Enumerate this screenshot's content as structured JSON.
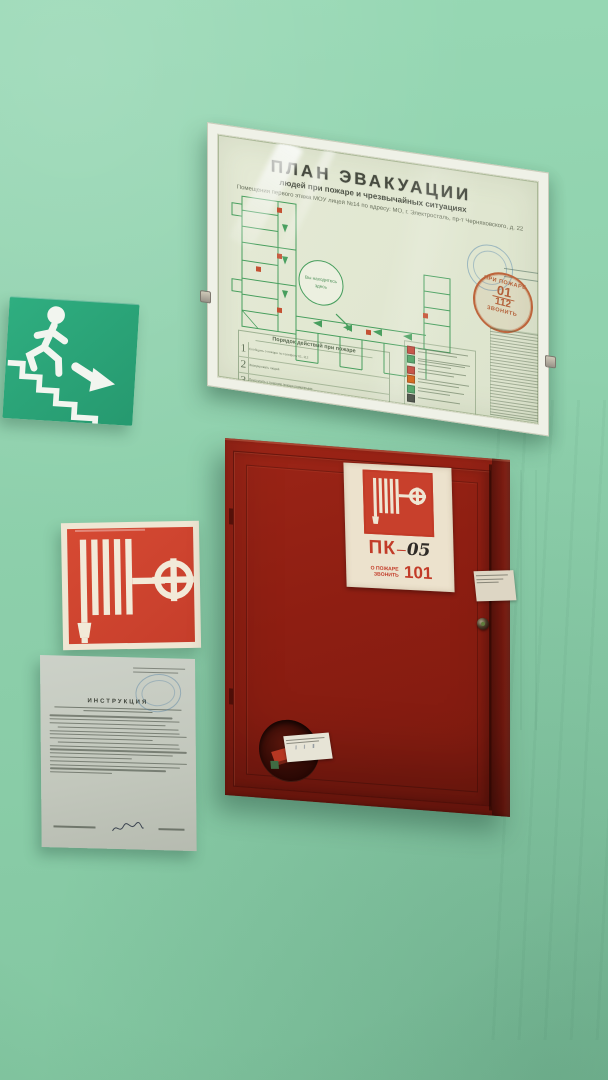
{
  "colors": {
    "wall": "#8fd1ad",
    "cabinet_red": "#8e1e12",
    "sign_red": "#cf4430",
    "sign_green": "#2aa77b",
    "plan_line_green": "#3f9b57",
    "badge_orange": "#b65930",
    "stamp_blue": "#7aa8c9"
  },
  "plan": {
    "title": "ПЛАН  ЭВАКУАЦИИ",
    "subtitle": "людей при пожаре и чрезвычайных ситуациях",
    "address": "Помещения первого этажа МОУ лицей №14 по адресу: МО, г. Электросталь, пр-т Черняховского, д. 22",
    "you_are_here_1": "Вы находитесь",
    "you_are_here_2": "здесь",
    "badge": {
      "top": "ПРИ ПОЖАРЕ",
      "num1": "01",
      "num2": "112",
      "bottom": "ЗВОНИТЬ"
    },
    "actions": {
      "title": "Порядок действий при пожаре",
      "rows": [
        {
          "num": "1",
          "text": "Сообщить о пожаре по телефону 01, 112"
        },
        {
          "num": "2",
          "text": "Эвакуировать людей"
        },
        {
          "num": "3",
          "text": "Приступить к тушению пожара первичными средствами"
        }
      ]
    }
  },
  "cabinet": {
    "label": {
      "prefix": "ПК",
      "dash": "–",
      "number": "05",
      "call_line1": "О ПОЖАРЕ",
      "call_line2": "ЗВОНИТЬ",
      "phone": "101"
    }
  },
  "document": {
    "title": "ИНСТРУКЦИЯ"
  },
  "icons": {
    "running-person-down-stairs-icon": "white pictogram of a person descending stairs",
    "down-right-arrow-icon": "white arrow pointing down-right",
    "fire-hose-reel-icon": "white fire hose reel with valve wheel",
    "fire-call-badge": "orange circle: call 01 / 112 in case of fire"
  }
}
